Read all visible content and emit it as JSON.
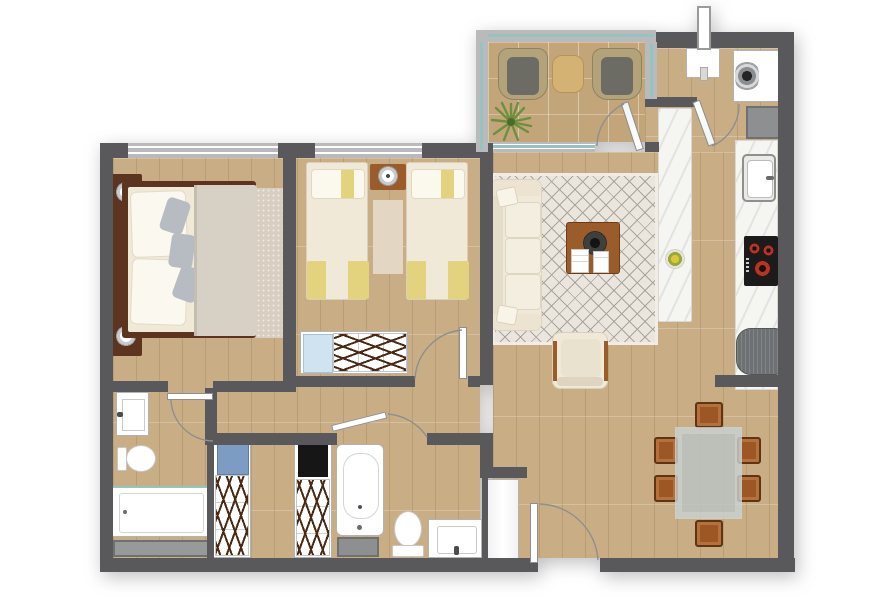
{
  "title": "apartment-floor-plan",
  "colors": {
    "wall": "#59595b",
    "railing": "#b9babc",
    "glass": "#96c2bf",
    "floor": "#c9ae85",
    "terraceFloor": "#c2a67a",
    "marble": "#f5f5f2",
    "cream": "#f0e9d8",
    "yellow": "#e3d37e",
    "pillowGray": "#b6bcc1",
    "blanketGray": "#d6d0c5",
    "woodDark": "#5d3420",
    "woodMid": "#9a5c2a",
    "rugLiving": "#ebe6dd",
    "rugLine": "#a8a49c",
    "rugMaster": "#d8cfc1",
    "runner": "#e3d7c3",
    "wicker": "#b2a37b",
    "cushion": "#6c6c64",
    "green": "#6d8f3e",
    "glassTable": "#b9c5c7",
    "shaft": "#98999b",
    "shaftDark": "#8d8f91",
    "fridge": "#6e7174",
    "burnerRed": "#b23527",
    "blueClothes": "#7d9cc4",
    "lightBlueClothes": "#cfe3f0",
    "darkClothes": "#161616",
    "hanger": "#4a2a12",
    "arc": "#8f8f8d",
    "doorLeaf": "#ffffff"
  },
  "plan": {
    "type": "2-bedroom-apartment",
    "rooms": [
      {
        "name": "terrace",
        "items": [
          "wicker-chair",
          "wicker-chair",
          "side-table",
          "potted-plant",
          "glass-railing"
        ]
      },
      {
        "name": "living-room",
        "items": [
          "three-seat-sofa",
          "throw-pillow",
          "throw-pillow",
          "coffee-table",
          "decor-bowl",
          "magazines",
          "armchair",
          "diamond-pattern-rug"
        ]
      },
      {
        "name": "kitchen",
        "items": [
          "island-counter",
          "fruit-bowl",
          "wall-counter",
          "sink",
          "cooktop-4-burner",
          "refrigerator"
        ]
      },
      {
        "name": "laundry-nook",
        "items": [
          "washing-machine",
          "water-heater",
          "service-shaft",
          "vent-pipe"
        ]
      },
      {
        "name": "dining-area",
        "items": [
          "glass-dining-table",
          "dining-chair",
          "dining-chair",
          "dining-chair",
          "dining-chair",
          "dining-chair",
          "dining-chair"
        ]
      },
      {
        "name": "entry",
        "items": [
          "entry-door",
          "entry-closet"
        ]
      },
      {
        "name": "hallway",
        "items": []
      },
      {
        "name": "master-bedroom",
        "items": [
          "double-bed",
          "pillow",
          "pillow",
          "accent-pillow",
          "accent-pillow",
          "accent-pillow",
          "blanket",
          "nightstand",
          "nightstand",
          "table-lamp",
          "table-lamp",
          "area-rug",
          "window"
        ]
      },
      {
        "name": "bedroom-2",
        "items": [
          "single-bed",
          "single-bed",
          "yellow-blanket",
          "yellow-blanket",
          "nightstand",
          "table-lamp",
          "runner-rug",
          "wardrobe",
          "window"
        ]
      },
      {
        "name": "ensuite-bathroom",
        "items": [
          "vanity-sink",
          "toilet",
          "shower",
          "service-shaft"
        ]
      },
      {
        "name": "family-bathroom",
        "items": [
          "wardrobe",
          "wardrobe",
          "bathtub",
          "toilet",
          "vanity-sink",
          "service-shaft"
        ]
      }
    ],
    "doors": [
      "entry-swing-door",
      "terrace-glass-door",
      "laundry-glass-door",
      "master-ensuite-door",
      "bedroom-2-door",
      "family-bathroom-door"
    ],
    "windows": [
      "master-bedroom-window",
      "bedroom-2-window",
      "terrace-window"
    ]
  }
}
